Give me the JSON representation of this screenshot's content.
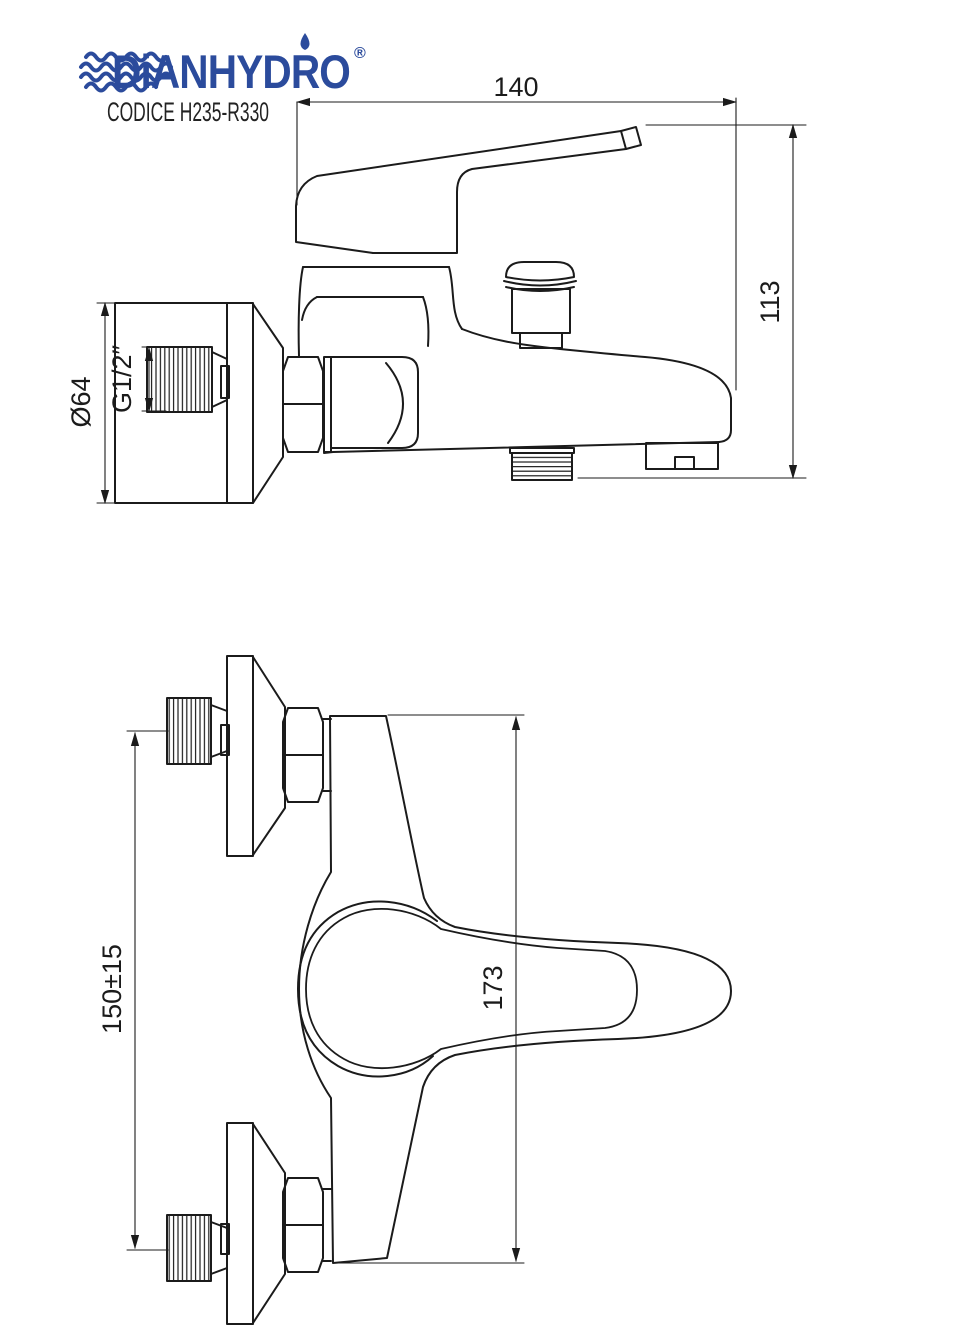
{
  "header": {
    "brand": "DiANHYDRO",
    "registered": "®",
    "code": "CODICE H235-R330"
  },
  "colors": {
    "brand_blue": "#2b4b9c",
    "line_color": "#1b1b1b"
  },
  "drawing": {
    "side_view": {
      "dim_width": "140",
      "dim_height": "113",
      "dim_flange_diameter": "Ø64",
      "dim_thread": "G1/2″"
    },
    "plan_view": {
      "dim_wall_centers": "150±15",
      "dim_body_length": "173"
    }
  }
}
